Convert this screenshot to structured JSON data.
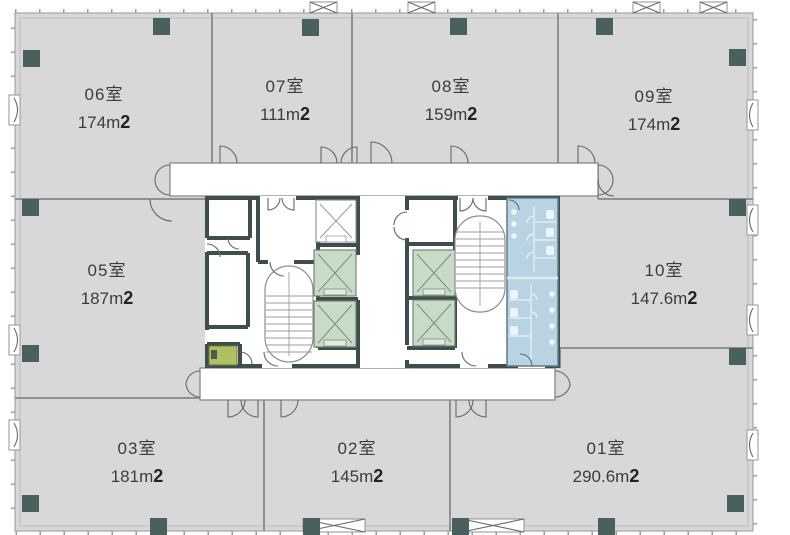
{
  "plan": {
    "type": "office-floor-plan",
    "unit_suffix": "m",
    "rooms": [
      {
        "id": "r06",
        "label": "06室",
        "area_value": "174",
        "area_unit": "m",
        "area_sup": "2"
      },
      {
        "id": "r07",
        "label": "07室",
        "area_value": "111",
        "area_unit": "m",
        "area_sup": "2"
      },
      {
        "id": "r08",
        "label": "08室",
        "area_value": "159",
        "area_unit": "m",
        "area_sup": "2"
      },
      {
        "id": "r09",
        "label": "09室",
        "area_value": "174",
        "area_unit": "m",
        "area_sup": "2"
      },
      {
        "id": "r05",
        "label": "05室",
        "area_value": "187",
        "area_unit": "m",
        "area_sup": "2"
      },
      {
        "id": "r10",
        "label": "10室",
        "area_value": "147.6",
        "area_unit": "m",
        "area_sup": "2"
      },
      {
        "id": "r03",
        "label": "03室",
        "area_value": "181",
        "area_unit": "m",
        "area_sup": "2"
      },
      {
        "id": "r02",
        "label": "02室",
        "area_value": "145",
        "area_unit": "m",
        "area_sup": "2"
      },
      {
        "id": "r01",
        "label": "01室",
        "area_value": "290.6",
        "area_unit": "m",
        "area_sup": "2"
      }
    ],
    "symbols": {
      "elevator_icon": "box with X cross",
      "stair_icon": "racetrack with treads",
      "door_icon": "quarter-circle swing arc",
      "column_icon": "filled dark square",
      "louver_icon": "trapezoid vent with X",
      "toilet_icon": "small stall fixtures on blue block"
    }
  },
  "colors": {
    "plate": "#d7d8d7",
    "column": "#4a605e",
    "core_wall": "#3e4d4d",
    "wall_line": "#8f918f",
    "corridor_white": "#ffffff",
    "elevator_green": "#c8dbc7",
    "bath_blue": "#b9d3e3",
    "utility_olive": "#b0bf62",
    "label_text": "#3c3c3c",
    "area_bold": "#222222"
  }
}
